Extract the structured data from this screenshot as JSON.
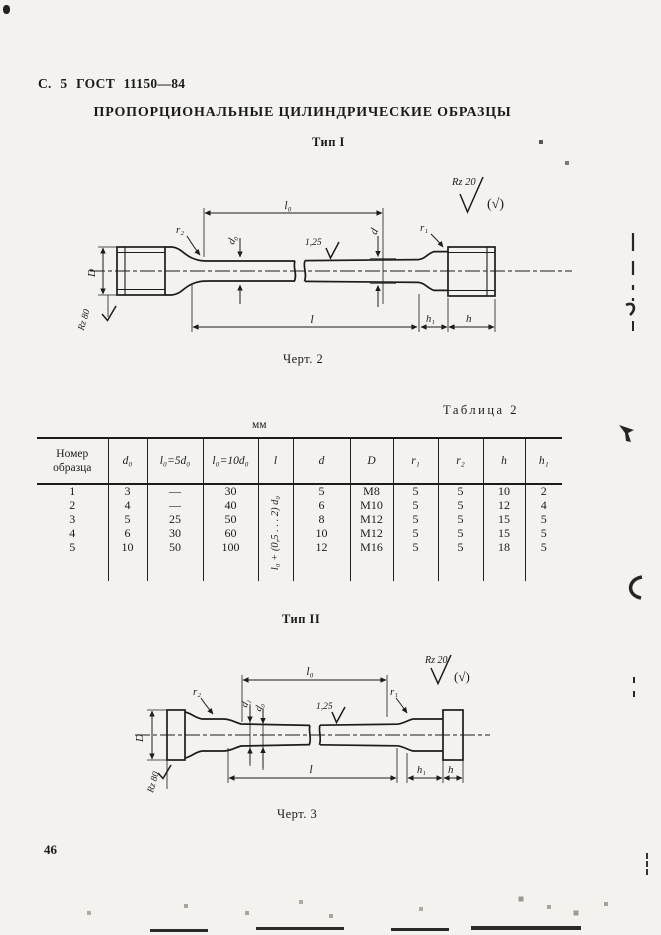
{
  "page": {
    "header": "С. 5  ГОСТ 11150—84",
    "title": "ПРОПОРЦИОНАЛЬНЫЕ ЦИЛИНДРИЧЕСКИЕ ОБРАЗЦЫ",
    "page_number": "46"
  },
  "figure1": {
    "heading": "Тип I",
    "caption": "Черт. 2",
    "labels": {
      "l0": "l₀",
      "r2": "r₂",
      "d0": "d₀",
      "roughness_gauge": "1,25",
      "d": "d",
      "r1": "r₁",
      "rz20": "Rz 20",
      "rz_paren": "(√)",
      "D_label": "D",
      "rz80": "Rz 80",
      "l": "l",
      "h1": "h₁",
      "h": "h"
    }
  },
  "table": {
    "label": "Таблица 2",
    "units": "мм",
    "columns": [
      "Номер образца",
      "d₀",
      "l₀=5d₀",
      "l₀=10d₀",
      "l",
      "d",
      "D",
      "r₁",
      "r₂",
      "h",
      "h₁"
    ],
    "l_formula": "l₀ + (0,5 . . . 2) d₀",
    "rows": [
      [
        "1",
        "3",
        "—",
        "30",
        "5",
        "M8",
        "5",
        "5",
        "10",
        "2"
      ],
      [
        "2",
        "4",
        "—",
        "40",
        "6",
        "M10",
        "5",
        "5",
        "12",
        "4"
      ],
      [
        "3",
        "5",
        "25",
        "50",
        "8",
        "M12",
        "5",
        "5",
        "15",
        "5"
      ],
      [
        "4",
        "6",
        "30",
        "60",
        "10",
        "M12",
        "5",
        "5",
        "15",
        "5"
      ],
      [
        "5",
        "10",
        "50",
        "100",
        "12",
        "M16",
        "5",
        "5",
        "18",
        "5"
      ]
    ]
  },
  "figure2": {
    "heading": "Тип II",
    "caption": "Черт. 3",
    "labels": {
      "l0": "l₀",
      "rz20": "Rz 20",
      "rz_paren": "(√)",
      "r2": "r₂",
      "r1": "r₁",
      "d1": "d₁",
      "d0": "d₀",
      "roughness_gauge": "1,25",
      "D_label": "D",
      "rz80": "Rz 80",
      "l": "l",
      "h1": "h₁",
      "h": "h"
    }
  }
}
